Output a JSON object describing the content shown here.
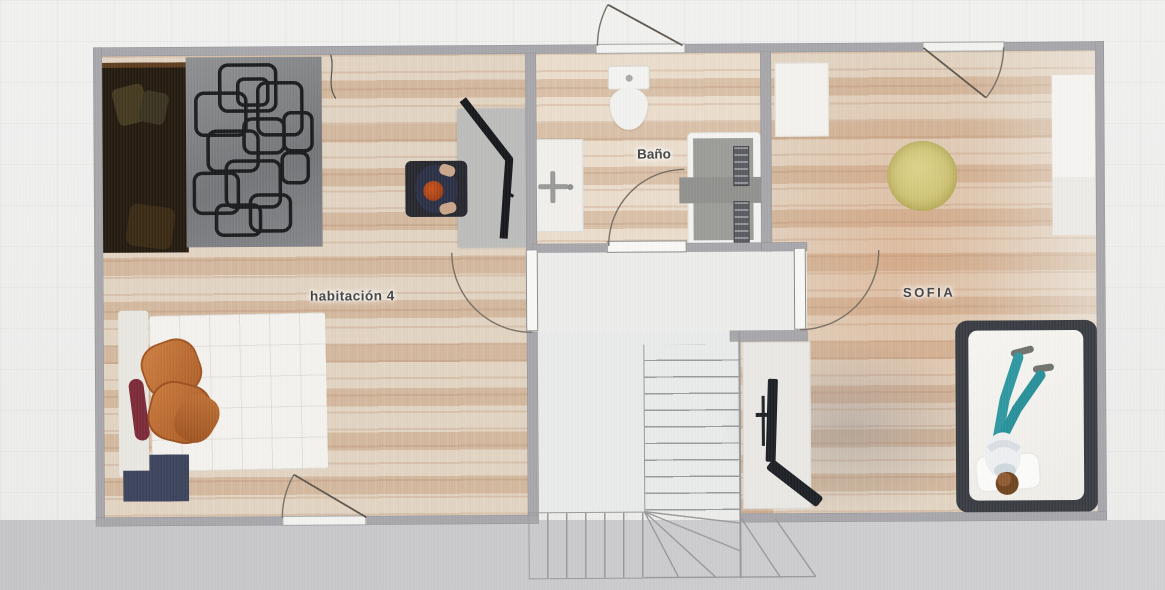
{
  "plan": {
    "rooms": [
      {
        "id": "habitacion-4",
        "label": "habitación 4",
        "furniture": [
          "double-bed-dark",
          "geometric-pattern-rug",
          "desk",
          "monitor",
          "office-chair",
          "person-sitting",
          "bed-white-duvet",
          "orange-pillows",
          "maroon-throw",
          "nightstand"
        ]
      },
      {
        "id": "bano",
        "label": "Baño",
        "furniture": [
          "toilet",
          "sink",
          "shower"
        ]
      },
      {
        "id": "sofia",
        "label": "SOFIA",
        "furniture": [
          "wardrobe-left",
          "wardrobe-right-upper",
          "wardrobe-right-lower",
          "round-rug-yellow",
          "gray-rug",
          "tv-cabinet",
          "tv",
          "leaning-panel",
          "double-bed",
          "person-lying"
        ]
      }
    ],
    "features": [
      "entrance-door-top",
      "sofia-top-door",
      "hall-door-habitacion",
      "hall-door-sofia",
      "bathroom-door",
      "exterior-door-bottom",
      "l-shaped-staircase-with-winders"
    ]
  },
  "theme": {
    "bg": "#ebebeb",
    "bg-bottom": "#c5c5c7",
    "wall": "#a7a7ab",
    "floor-wood-light": "#e2d3c1",
    "floor-wood-stripe": "#d2b79d",
    "hall-floor": "#ececeb",
    "stair-line": "#9a9a9a",
    "door-arc": "#776f63",
    "rug-yellow": "#d3c879",
    "rug-gray": "#8f8e91",
    "pillow-orange": "#c1713a",
    "person-teal": "#2f98a0",
    "dark-object": "#1d2025",
    "label": "#454545"
  }
}
